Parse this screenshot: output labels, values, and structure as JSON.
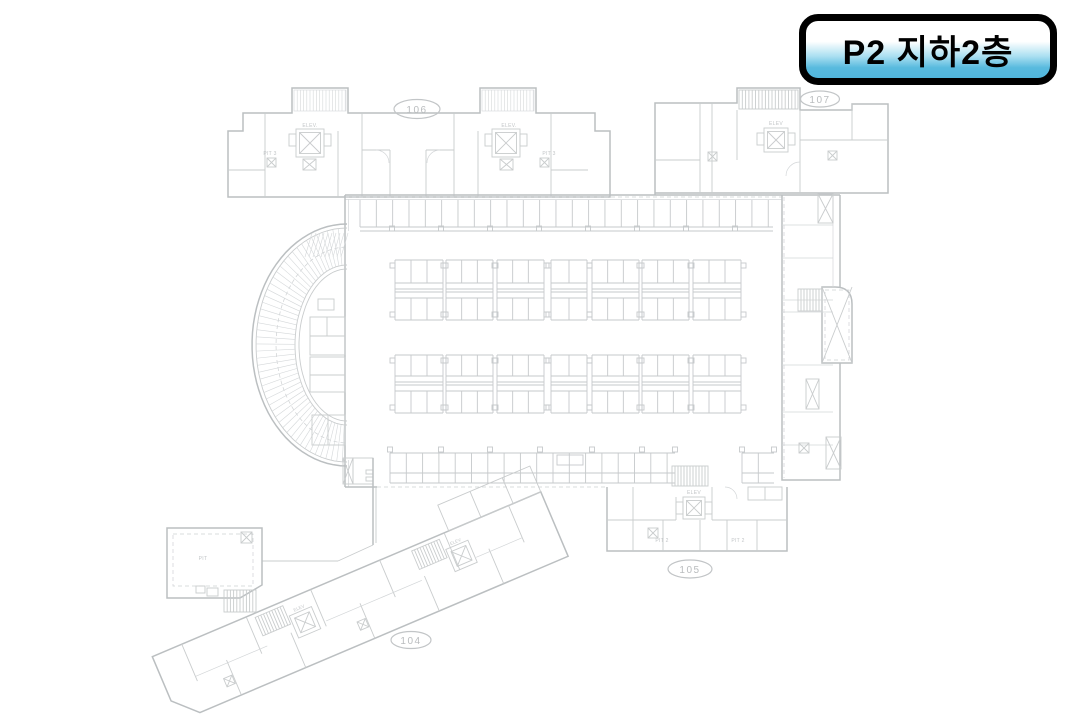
{
  "badge": {
    "label": "P2 지하2층",
    "border_color": "#000000",
    "gradient_top": "#ffffff",
    "gradient_bottom": "#52b7dc",
    "text_color": "#000000"
  },
  "floor_plan": {
    "background": "#ffffff",
    "line_color": "#c9cccd",
    "wall_color": "#bbbfc1",
    "units": [
      {
        "id": "106"
      },
      {
        "id": "107"
      },
      {
        "id": "105"
      },
      {
        "id": "104"
      }
    ],
    "labels": {
      "elev_dot": "ELEV.",
      "elev": "ELEV",
      "pit3": "PIT 3",
      "pit2": "PIT 2",
      "pit": "PIT"
    }
  }
}
